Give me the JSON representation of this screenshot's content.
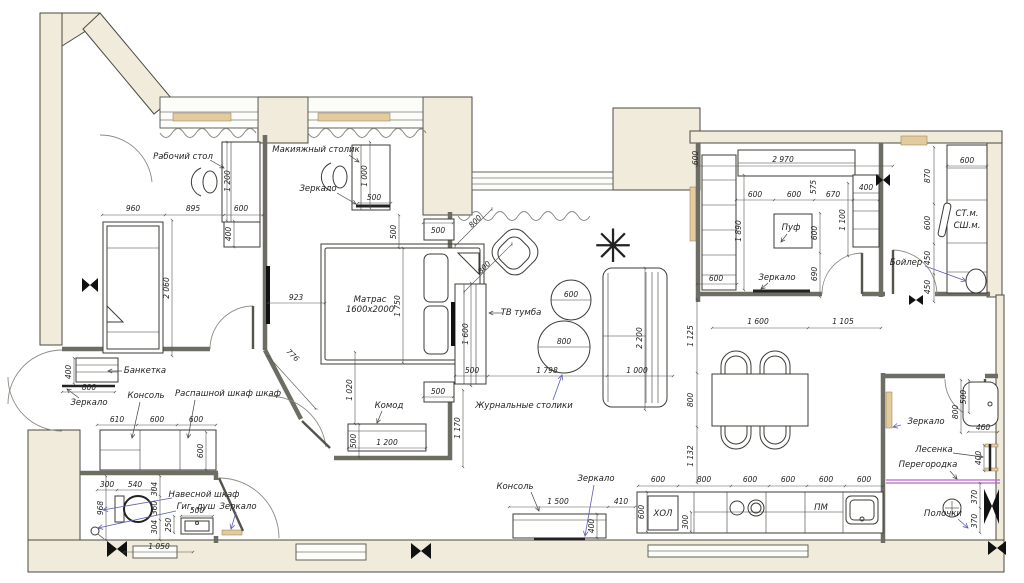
{
  "title": "План квартиры с расстановкой мебели",
  "colors": {
    "wall_fill": "#f0ebda",
    "wall_stroke": "#4b4a42",
    "leader_blue": "#5b5fa8",
    "partition_purple": "#b468c8",
    "sill_tan": "#e4cb9d"
  },
  "icons": {
    "plant": "✳"
  },
  "labels": {
    "desk": "Рабочий стол",
    "makeup": "Макияжный столик",
    "mirror": "Зеркало",
    "mat1": "Матрас",
    "mat2": "1600х2000",
    "banquette": "Банкетка",
    "console": "Консоль",
    "wardrobe": "Распашной шкаф шкаф",
    "cab": "Навесной шкаф",
    "shower": "Гиг. душ",
    "komod": "Комод",
    "tv": "ТВ тумба",
    "coffee": "Журнальные столики",
    "pouf": "Пуф",
    "boiler": "Бойлер",
    "wm1": "СТ.м.",
    "wm2": "СШ.м.",
    "fridge": "ХОЛ",
    "pm": "ПМ",
    "ladder": "Лесенка",
    "partition": "Перегородка",
    "shelves": "Полочки"
  },
  "dims": {
    "b1": [
      "1 200",
      "960",
      "895",
      "600",
      "400",
      "2 060"
    ],
    "b2": [
      "1 000",
      "500",
      "500",
      "500",
      "923",
      "1 750",
      "776",
      "1 020",
      "500",
      "1 200",
      "500"
    ],
    "lv": [
      "800",
      "800",
      "600",
      "800",
      "1 600",
      "500",
      "1 798",
      "1 000",
      "2 200",
      "1 170",
      "1 500",
      "410",
      "400"
    ],
    "cl": [
      "600",
      "2 970",
      "600",
      "600",
      "575",
      "670",
      "400",
      "1 100",
      "1 890",
      "600",
      "690",
      "600"
    ],
    "la": [
      "600",
      "870",
      "600",
      "450",
      "450"
    ],
    "dn": [
      "1 600",
      "1 105",
      "1 125",
      "800",
      "1 132"
    ],
    "kt": [
      "600",
      "800",
      "600",
      "600",
      "600",
      "600",
      "600",
      "300"
    ],
    "bt": [
      "500",
      "800",
      "460",
      "400",
      "370",
      "370"
    ],
    "hl": [
      "400",
      "800",
      "610",
      "600",
      "600",
      "600",
      "300",
      "540",
      "304",
      "968",
      "360",
      "304",
      "250",
      "500",
      "1 050"
    ]
  }
}
